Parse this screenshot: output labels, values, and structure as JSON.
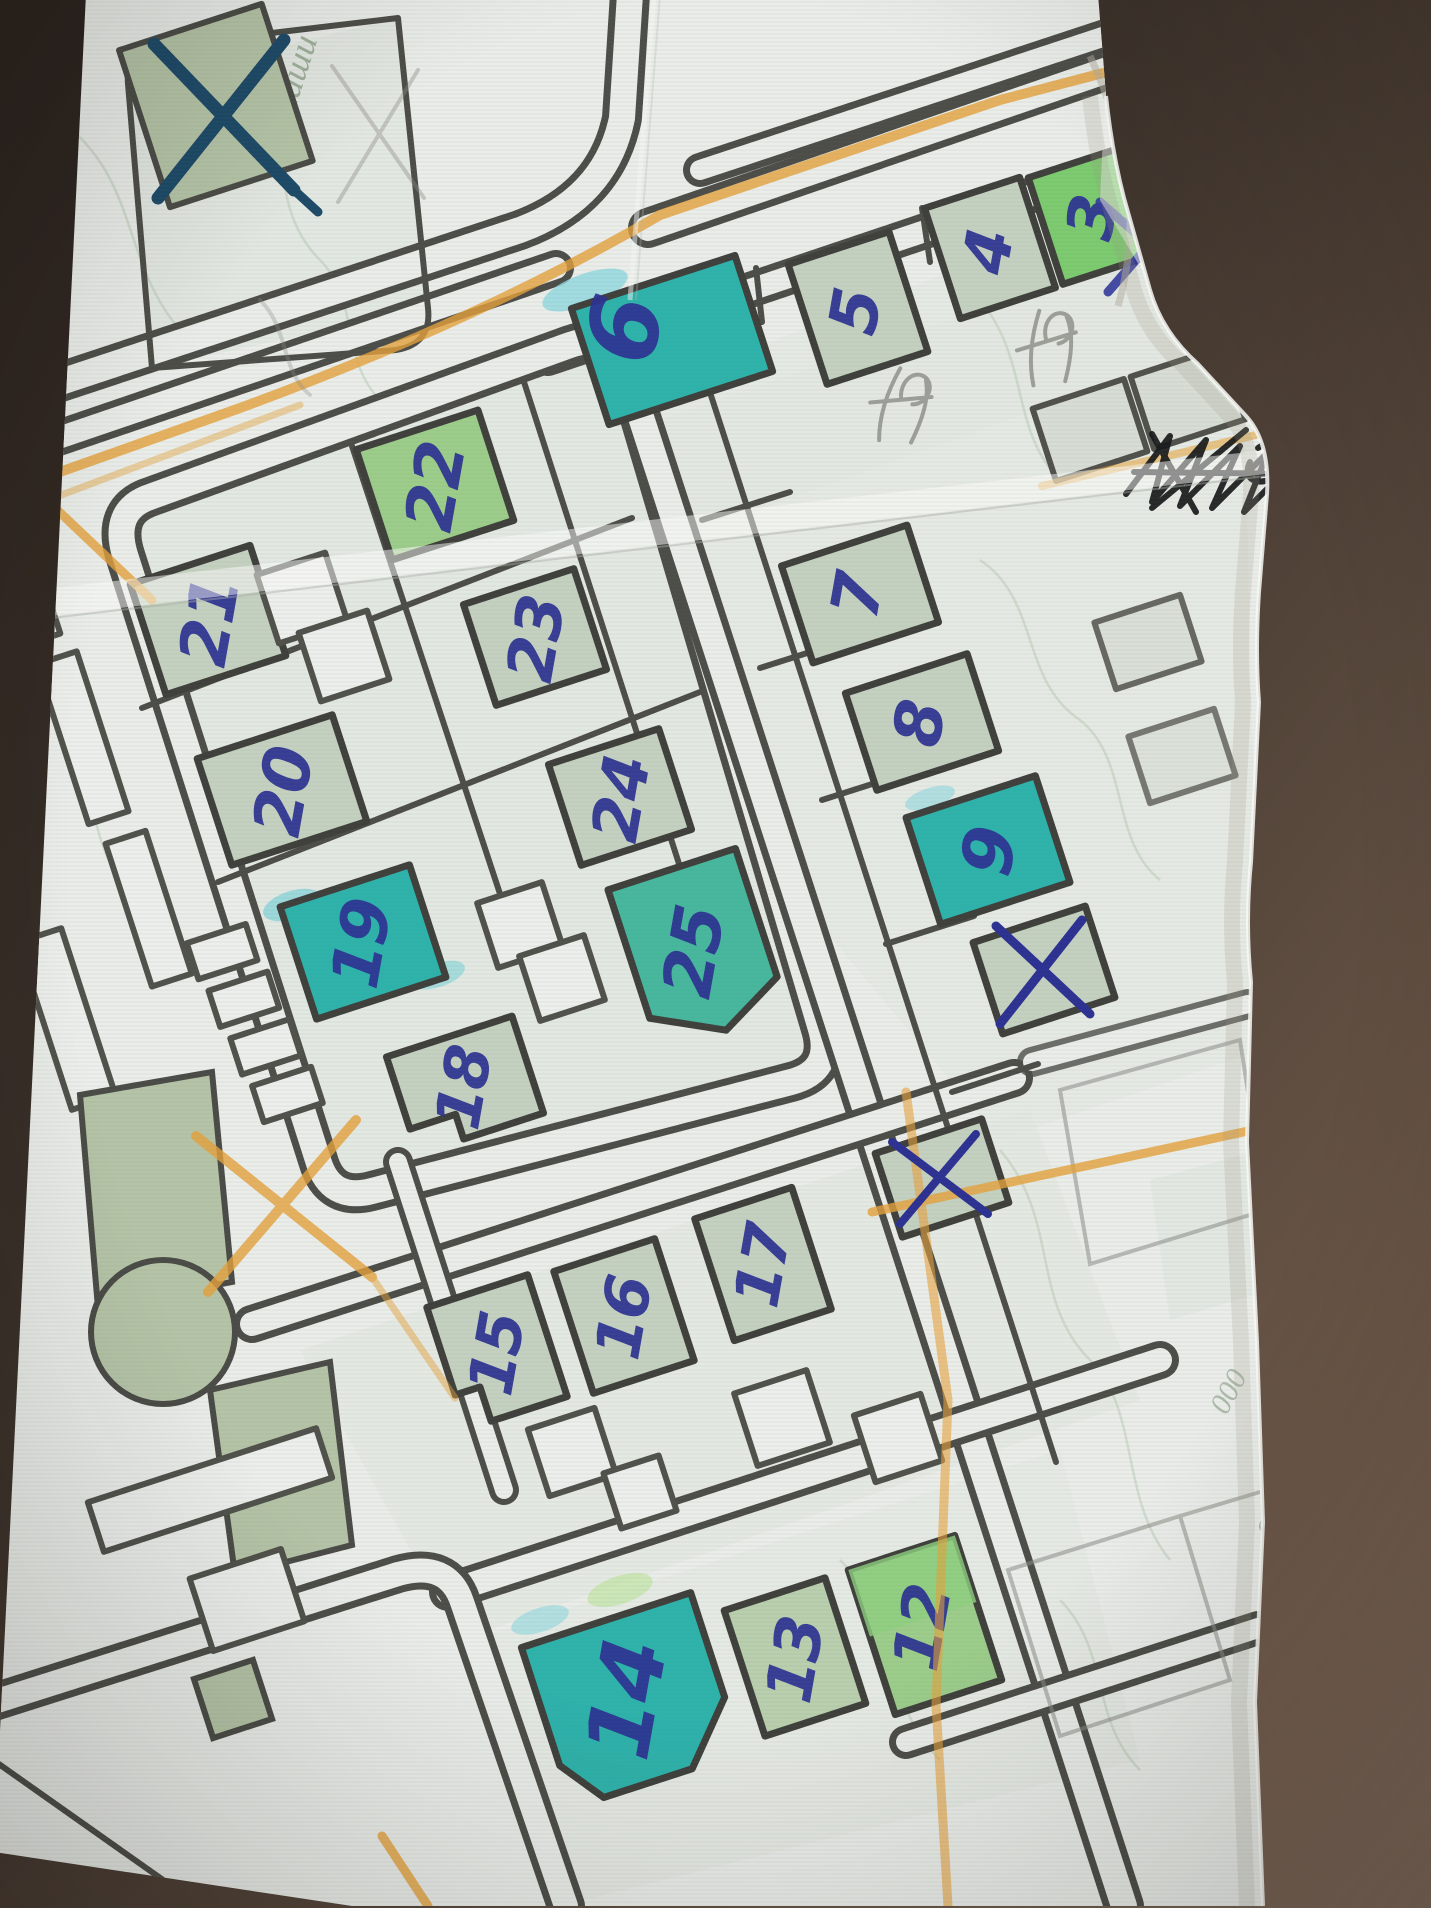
{
  "photo": {
    "subject": "hand-annotated printed street map on creased paper",
    "background_surface": "dark brown tabletop visible along right edge and corners"
  },
  "map": {
    "buildings": [
      {
        "label": "3",
        "highlight": "bright-green"
      },
      {
        "label": "4",
        "highlight": "pale-green"
      },
      {
        "label": "5",
        "highlight": "pale-green"
      },
      {
        "label": "6",
        "highlight": "teal"
      },
      {
        "label": "7",
        "highlight": "pale-green"
      },
      {
        "label": "8",
        "highlight": "pale-green"
      },
      {
        "label": "9",
        "highlight": "teal"
      },
      {
        "label": "12",
        "highlight": "green"
      },
      {
        "label": "13",
        "highlight": "pale-green"
      },
      {
        "label": "14",
        "highlight": "teal"
      },
      {
        "label": "15",
        "highlight": "pale-green"
      },
      {
        "label": "16",
        "highlight": "pale-green"
      },
      {
        "label": "17",
        "highlight": "pale-green"
      },
      {
        "label": "18",
        "highlight": "pale-green"
      },
      {
        "label": "19",
        "highlight": "teal"
      },
      {
        "label": "20",
        "highlight": "pale-green"
      },
      {
        "label": "21",
        "highlight": "pale-green"
      },
      {
        "label": "22",
        "highlight": "green"
      },
      {
        "label": "23",
        "highlight": "pale-green"
      },
      {
        "label": "24",
        "highlight": "pale-green"
      },
      {
        "label": "25",
        "highlight": "teal-green"
      }
    ],
    "x_marks": [
      {
        "location": "top-left green building",
        "symbol": "X",
        "color": "dark blue-teal pen"
      },
      {
        "location": "green building below building 9",
        "symbol": "X",
        "color": "blue pen"
      },
      {
        "location": "small building lower right of 25",
        "symbol": "x",
        "color": "blue pen"
      },
      {
        "location": "paper edge, top right",
        "symbol": "X",
        "color": "blue pen"
      }
    ],
    "scribbles": [
      {
        "type": "black pen scribble, crossed-out illegible word",
        "location": "right side above centre"
      },
      {
        "type": "pencil note, illegible",
        "location": "left of building 7"
      },
      {
        "type": "pencil note, illegible",
        "location": "above building 7"
      },
      {
        "type": "pencil X, faint",
        "location": "top left over street name"
      }
    ],
    "orange_marks": "orange pencil: line along main avenue, short stroke toward building 21, X beside park, long vertical line and cross strokes lower right, corner stroke bottom left",
    "printed_labels": {
      "street_name": "Сомаши",
      "corner_numbers": [
        "000",
        "900"
      ]
    }
  },
  "colors": {
    "pen-blue": "#2c3192",
    "teal": "#2eb3ac",
    "teal-green": "#47b79e",
    "bright-green": "#7ccb6e",
    "pale-green": "#c5d1c0",
    "sage": "#b5c4a7",
    "orange": "#e5a23c",
    "ink-black": "#17181a",
    "street-dark": "#4d4d48",
    "paper": "#eaede9",
    "bg-dark": "#3a302a"
  }
}
